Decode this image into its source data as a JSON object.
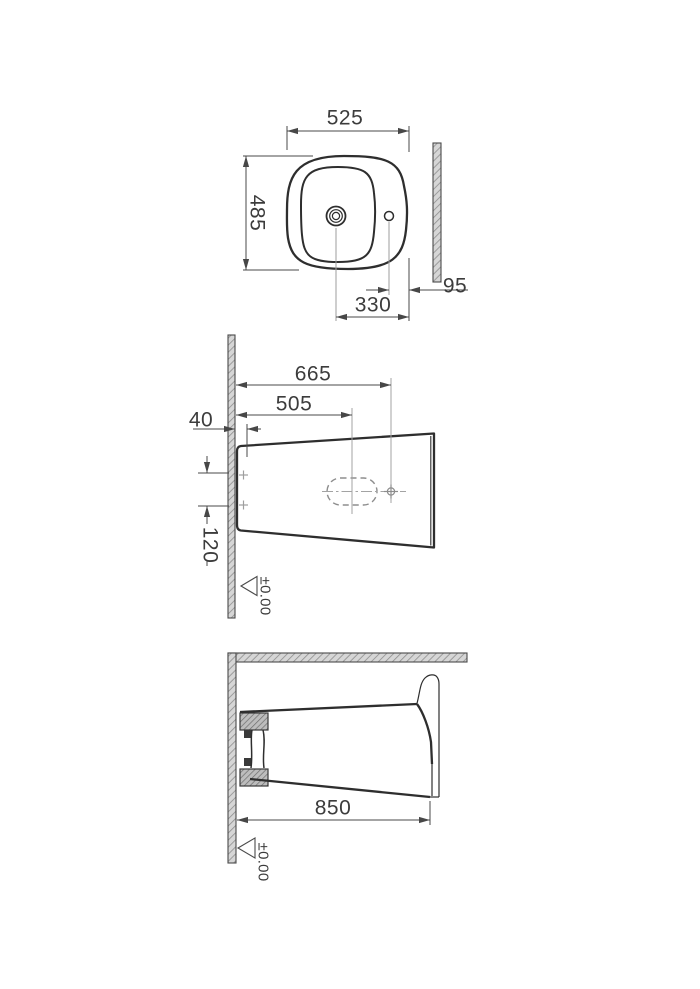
{
  "drawing": {
    "plan_view": {
      "overall_width": "525",
      "overall_depth": "485",
      "tap_hole_offset": "330",
      "side_hole_edge_gap": "95"
    },
    "side_view": {
      "tap_hole_distance": "665",
      "drain_distance": "505",
      "fixing_hole_offset": "40",
      "fixing_hole_spacing": "120",
      "datum_level": "±0.00"
    },
    "elevation_view": {
      "overall_height": "850",
      "datum_level": "±0.00"
    }
  }
}
